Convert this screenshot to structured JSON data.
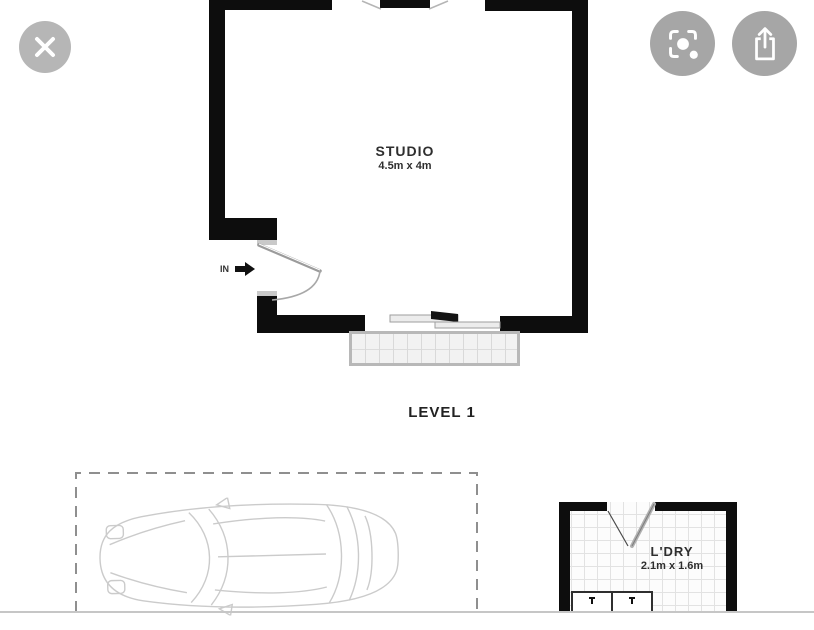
{
  "viewer": {
    "close_button": {
      "icon": "close-x"
    },
    "lens_button": {
      "icon": "camera-lens-search"
    },
    "share_button": {
      "icon": "share-up-arrow"
    },
    "colors": {
      "close_circle": "#b6b6b6",
      "action_circle": "#a6a6a6",
      "wall": "#0d0d0d"
    }
  },
  "floorplan": {
    "studio": {
      "name": "STUDIO",
      "dims": "4.5m x 4m"
    },
    "entry_label": "IN",
    "level_label": "LEVEL 1",
    "laundry": {
      "name": "L'DRY",
      "dims": "2.1m x 1.6m"
    },
    "carport": {
      "contents": "car-top-view"
    }
  }
}
